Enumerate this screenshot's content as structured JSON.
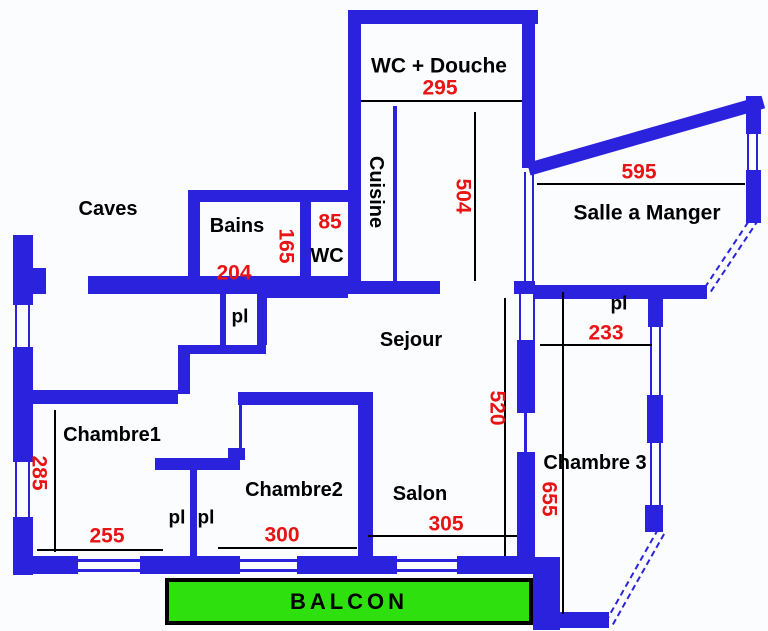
{
  "colors": {
    "wall": "#2b22dd",
    "line": "#000000",
    "dim": "#e81313",
    "balcony": "#2fe00f",
    "bg": "#fafcfe"
  },
  "labels": {
    "wc_douche": "WC + Douche",
    "cuisine": "Cuisine",
    "salle_a_manger": "Salle a Manger",
    "caves": "Caves",
    "bains": "Bains",
    "wc": "WC",
    "sejour": "Sejour",
    "salon": "Salon",
    "chambre1": "Chambre1",
    "chambre2": "Chambre2",
    "chambre3": "Chambre 3",
    "pl_hall": "pl",
    "pl_right": "pl",
    "pl_closet1": "pl",
    "pl_closet2": "pl",
    "balcon": "BALCON"
  },
  "dimensions": {
    "wc_douche_width": "295",
    "cuisine_height": "504",
    "salle_width": "595",
    "bains_width": "204",
    "bains_depth": "165",
    "wc_width": "85",
    "pl_right_width": "233",
    "sejour_salon_height": "520",
    "chambre3_height": "655",
    "chambre1_height": "285",
    "chambre1_width": "255",
    "chambre2_width": "300",
    "salon_width": "305"
  }
}
